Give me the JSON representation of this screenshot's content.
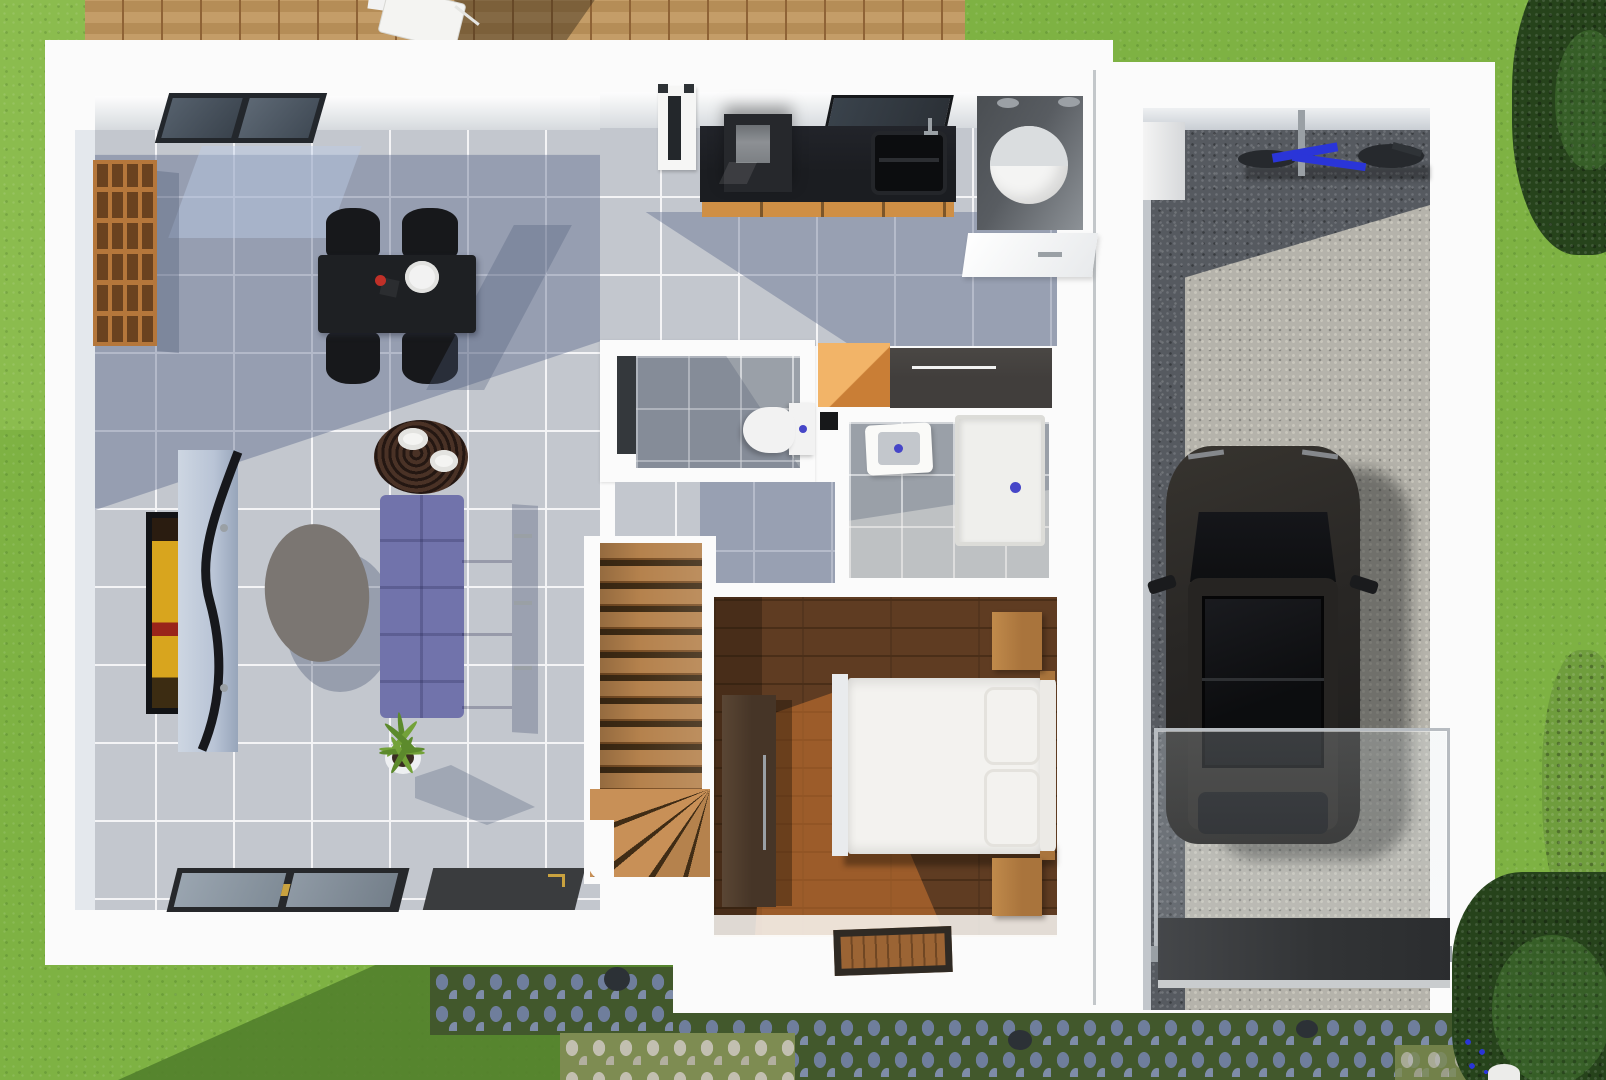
{
  "scene": {
    "kind": "3d-floor-plan-top-down-render",
    "floors": 1
  },
  "palette": {
    "grass": "#7eb243",
    "grassLight": "#92c254",
    "grassShadow": "#527f2c",
    "deckWood": "#c0965c",
    "deckLine": "#8f6336",
    "houseWhite": "#fbfbfb",
    "wallFace": "#d6dade",
    "wallShade": "#e4e8ed",
    "tile": "#c3c7ce",
    "grout": "#f4f4f6",
    "bathTile": "#9aa0a8",
    "counterBlack": "#1b1d21",
    "cabinetWood": "#cf8f45",
    "applianceGray": "#8d9094",
    "windowDark": "#2b3036",
    "slotDark": "#23272b",
    "boilerDark": "#585c61",
    "boilerWhite": "#f4f4f3",
    "porcelain": "#f3f3f1",
    "blueAccent": "#4646c8",
    "orangeCabinet": "#f2b468",
    "sideboard": "#413e3c",
    "stairWood": "#b5824d",
    "stairLine": "#7c5026",
    "stairDark": "#402c15",
    "bedFloor": "#5f3c22",
    "bedFloorLine": "#4a2e18",
    "bedSun": "#c27434",
    "wardrobe": "#463527",
    "bedWhite": "#f3f2ef",
    "nightstand": "#a9743c",
    "matBrown": "#9b6434",
    "matBorder": "#2f2a24",
    "gravel": "#565a60",
    "gravelDot": "#6e7177",
    "gravelSun": "#b5b3ab",
    "gravelSunDot": "#c8c6bc",
    "carBody": "#292725",
    "carGlass": "#0e0f11",
    "chrome": "#9aa0a5",
    "bikeBlue": "#2a35d8",
    "wheelDark": "#26292d",
    "railFrame": "#b7bcc1",
    "doorMatDark": "#3a3c3e",
    "threshold": "#c9ccce",
    "cobGroutS": "#42582c",
    "cobStoneS": "#6f7e9c",
    "cobStoneS2": "#7e8ca8",
    "cobGroutL": "#7e8c52",
    "cobStoneL": "#c2bfb0",
    "cobStoneL2": "#b2af9f",
    "treeDark": "#26431b",
    "treeMid": "#3a652a",
    "bushLight": "#6f9d3d",
    "sofa": "#7173ab",
    "sofaDark": "#585a92",
    "tableBlack": "#1e2023",
    "chairBlack": "#17181b",
    "plate": "#f2f2f2",
    "sideTableWood": "#31201a",
    "coffeeTable": "#7b7672",
    "plantGreen": "#5c8a2c",
    "plantGreen2": "#73a238",
    "potWhite": "#eef0f2",
    "soil": "#3a2d22",
    "tvFrame": "#121316",
    "tvYellow": "#d8a51e",
    "tvRed": "#99241a",
    "tvStand": "#b9c4d6",
    "standEdge": "#17181c",
    "glassPane": "#8a95a1",
    "gold": "#c9a23f",
    "shelfFrame": "#b5773b",
    "shelfCell": "#6a421f",
    "toiletWhite": "#f2f2f2",
    "showerTray": "#efefec",
    "basinGray": "#c3c7cc"
  },
  "objects": [
    "lawn",
    "wood-deck",
    "deck-chair",
    "house",
    "garage",
    "living-room",
    "dining-table",
    "dining-chairs",
    "bookshelf",
    "ceiling-window",
    "tv-screen",
    "tv-stand",
    "coffee-table",
    "sofa",
    "side-table",
    "house-plant",
    "patio-door",
    "door-mat",
    "kitchen-counter",
    "cooktop",
    "kitchen-sink",
    "kitchen-window",
    "entry-door",
    "water-heater",
    "utility-cabinet",
    "wc-toilet",
    "bathroom-washbasin",
    "shower-tray",
    "orange-cabinet",
    "sideboard",
    "staircase",
    "bedroom",
    "double-bed",
    "pillows",
    "wardrobe",
    "nightstands",
    "bedroom-doormat",
    "gravel-floor",
    "bicycle",
    "car",
    "glass-railing",
    "garage-door-mat",
    "cobblestone-path",
    "drain-covers",
    "trees",
    "bushes",
    "blue-flowers",
    "white-planter"
  ]
}
